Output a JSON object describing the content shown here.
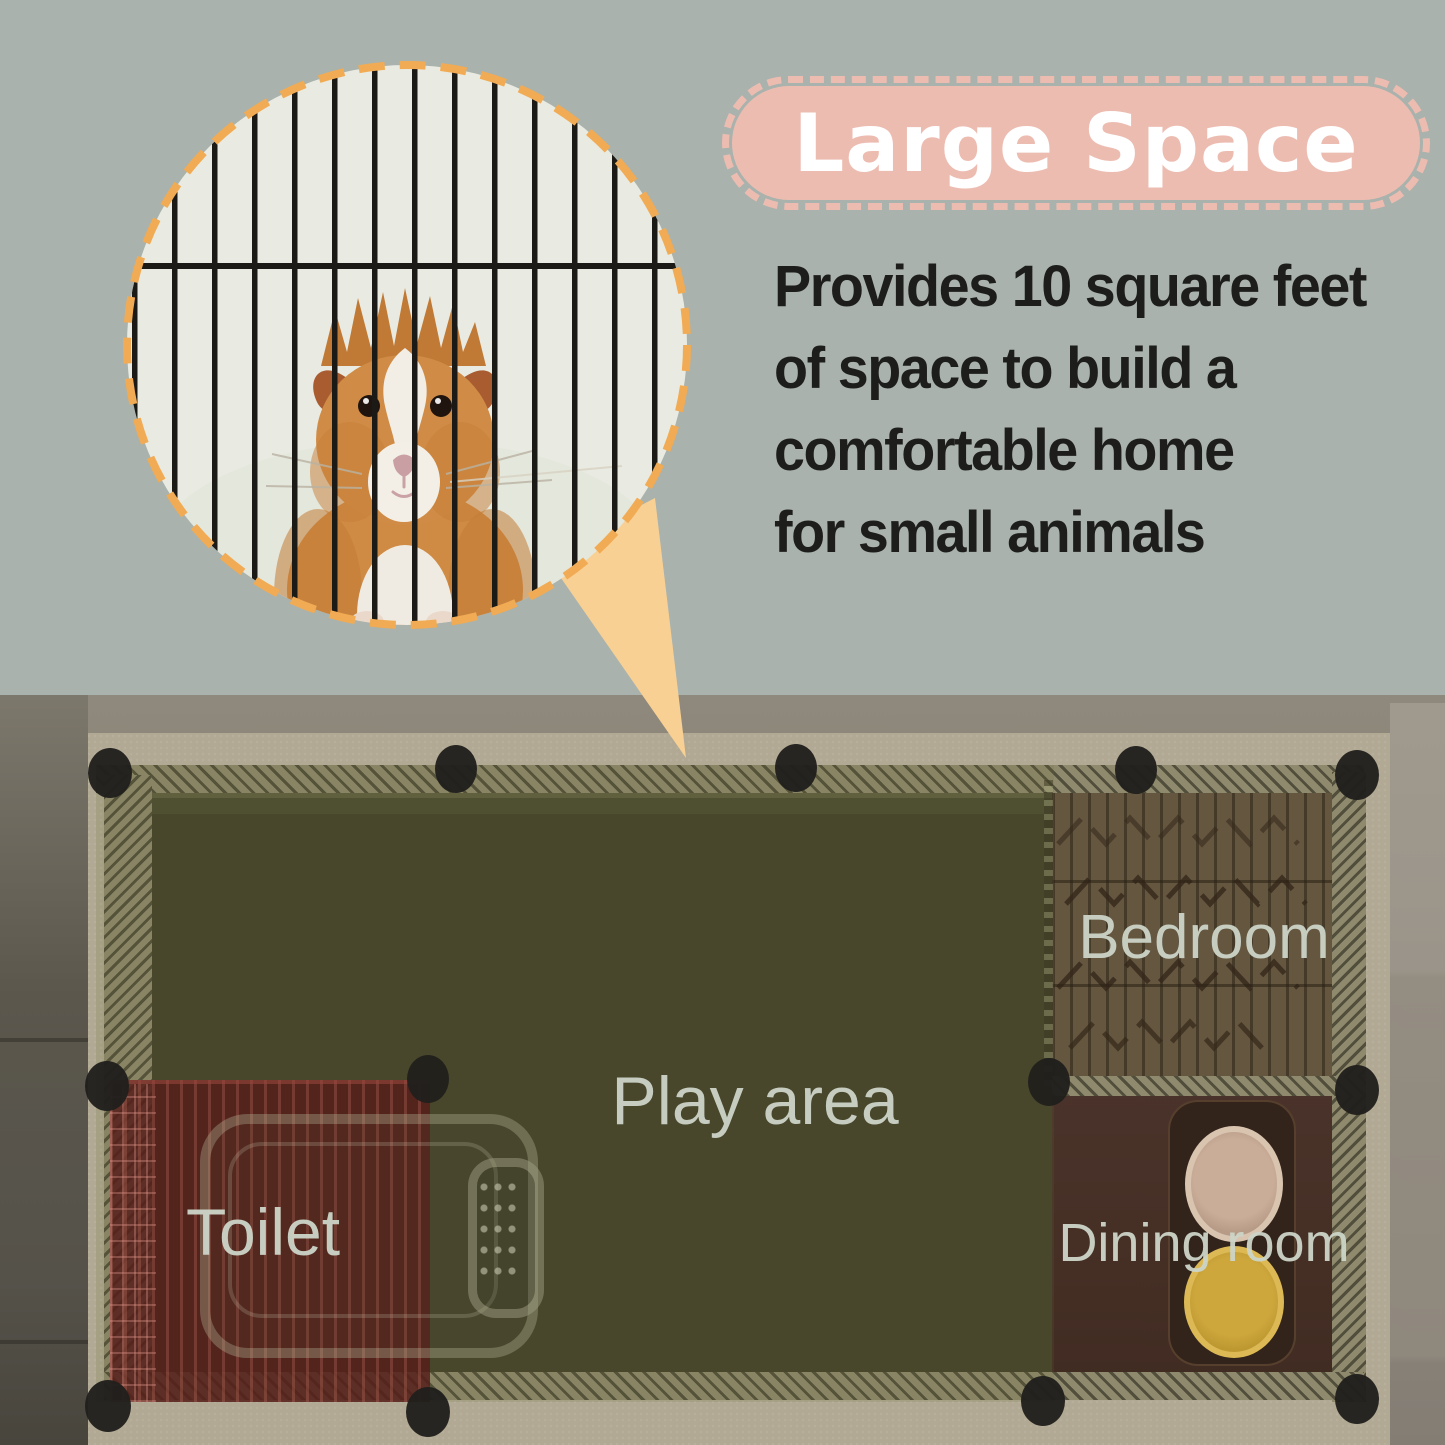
{
  "meta": {
    "type": "product-feature-infographic",
    "background_color": "#a9b2ac"
  },
  "banner": {
    "title": "Large Space",
    "background_color": "#edbcb1",
    "text_color": "#ffffff"
  },
  "description": {
    "text_color": "#1d1d1b",
    "lines": [
      "Provides 10 square feet",
      "of space to build a",
      "comfortable home",
      "for small animals"
    ]
  },
  "callout": {
    "shape": "dashed-magnifier-circle",
    "border_color": "#f1ab54",
    "pointer_color": "#f8d093",
    "inset_background": "#e9ebe2",
    "subject": "guinea pig behind black cage bars"
  },
  "floorplan": {
    "label_color": "#cdd5c8",
    "areas": [
      {
        "id": "play-area",
        "label": "Play area",
        "color": "#42402a"
      },
      {
        "id": "bedroom",
        "label": "Bedroom",
        "color": "#65563f"
      },
      {
        "id": "toilet",
        "label": "Toilet",
        "color": "#58201c"
      },
      {
        "id": "dining-room",
        "label": "Dining room",
        "color": "#452f25"
      }
    ],
    "furniture": [
      {
        "id": "litter-pan"
      },
      {
        "id": "food-bowl-top",
        "color": "#c9ad99"
      },
      {
        "id": "food-bowl-bottom",
        "color": "#cda73c"
      }
    ]
  }
}
